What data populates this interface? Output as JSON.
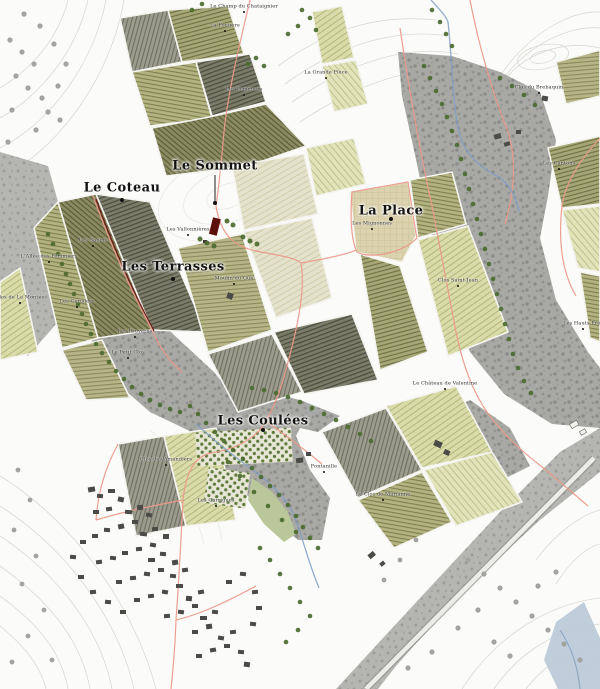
{
  "map": {
    "major_labels": [
      {
        "text": "Le Sommet",
        "x": 215,
        "y": 166,
        "dot_y": 203
      },
      {
        "text": "Le Coteau",
        "x": 122,
        "y": 188,
        "dot_y": 200
      },
      {
        "text": "Les Terrasses",
        "x": 173,
        "y": 267,
        "dot_y": 279
      },
      {
        "text": "La Place",
        "x": 391,
        "y": 211,
        "dot_y": 219
      },
      {
        "text": "Les Coulées",
        "x": 263,
        "y": 421,
        "dot_y": 430
      }
    ],
    "minor_labels": [
      {
        "text": "Le Champ du Chataignier",
        "x": 244,
        "y": 6
      },
      {
        "text": "La Fougère",
        "x": 225,
        "y": 25
      },
      {
        "text": "La Grande Pièce",
        "x": 326,
        "y": 72
      },
      {
        "text": "Les Pommiers",
        "x": 244,
        "y": 89
      },
      {
        "text": "Clos du Brebaquin",
        "x": 539,
        "y": 87
      },
      {
        "text": "Les Cantons",
        "x": 559,
        "y": 163
      },
      {
        "text": "Les Mignonnes",
        "x": 372,
        "y": 223
      },
      {
        "text": "Clos Saint-Jean",
        "x": 458,
        "y": 280
      },
      {
        "text": "Les Vallonnières",
        "x": 188,
        "y": 229
      },
      {
        "text": "Moulin du Gué",
        "x": 234,
        "y": 278
      },
      {
        "text": "Les Sapins",
        "x": 93,
        "y": 240
      },
      {
        "text": "L'Allée des Pommiers",
        "x": 49,
        "y": 256
      },
      {
        "text": "Clos de La Montée",
        "x": 20,
        "y": 297
      },
      {
        "text": "Les Cerisiers",
        "x": 77,
        "y": 301
      },
      {
        "text": "Les Bruyères",
        "x": 135,
        "y": 331
      },
      {
        "text": "Le Petit Clos",
        "x": 128,
        "y": 352
      },
      {
        "text": "Clos des Amandiers",
        "x": 166,
        "y": 459
      },
      {
        "text": "Les Garrigues",
        "x": 216,
        "y": 500
      },
      {
        "text": "Fontanille",
        "x": 324,
        "y": 466
      },
      {
        "text": "Le Clos de Marianne",
        "x": 383,
        "y": 494
      },
      {
        "text": "Le Château de Valentine",
        "x": 445,
        "y": 383
      },
      {
        "text": "Les Hauts Prés",
        "x": 583,
        "y": 323
      }
    ],
    "colors": {
      "road_pink": "#EC9A8A",
      "accent_dark_red": "#6B1A14",
      "stream_blue": "#7F9FC5",
      "river_fill": "#B9C9D8",
      "field_olive": "#A6A776",
      "field_pale_green": "#D9DBA9",
      "woodland_gray": "#A8A8A4",
      "tree_green": "#4C6B2F",
      "building_gray": "#4A4A46",
      "contour_gray": "#D8D8D3",
      "paper": "#FBFBF9"
    }
  }
}
